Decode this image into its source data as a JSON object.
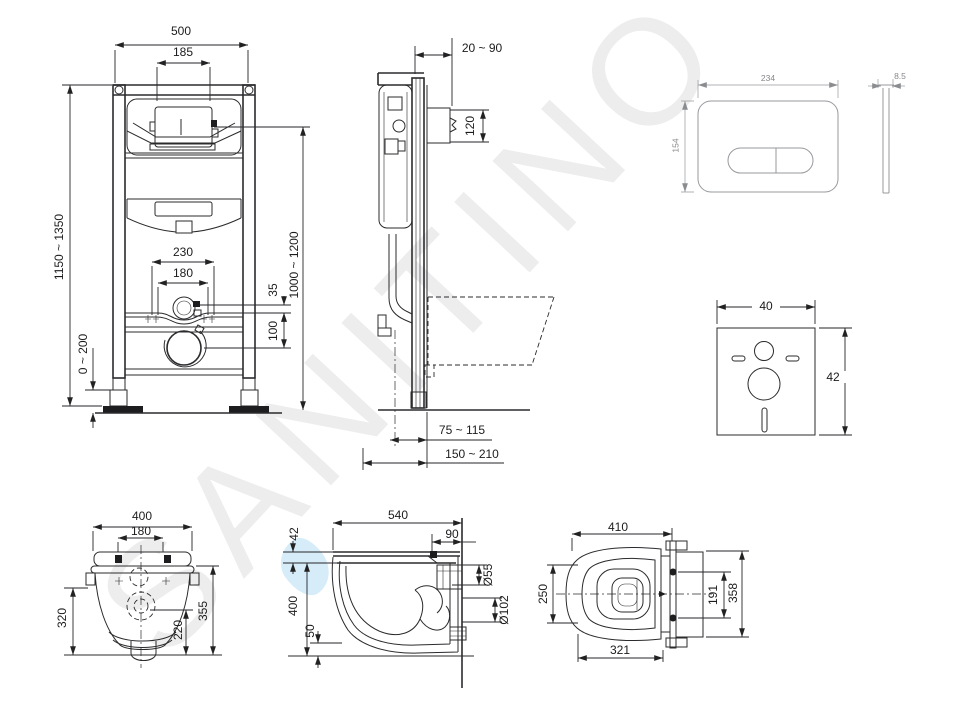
{
  "watermark": {
    "text": "SANITINO",
    "color": "#ededed",
    "drop_color": "#d6ecf8"
  },
  "views": {
    "frame_front": {
      "dims": {
        "overall_width": "500",
        "cistern_width": "185",
        "frame_height": "1150 ~ 1350",
        "leg_adjust": "0 ~ 200",
        "fixing_outer": "230",
        "fixing_inner": "180",
        "offset_small": "35",
        "offset_mid": "100",
        "outlet_height": "1000 ~ 1200"
      }
    },
    "frame_side": {
      "dims": {
        "wall_distance": "20 ~ 90",
        "spigot_length": "120",
        "outlet_offset": "75 ~ 115",
        "outlet_depth": "150 ~ 210"
      }
    },
    "flush_plate": {
      "dims": {
        "width": "234",
        "height": "154",
        "thickness": "8.5"
      }
    },
    "sound_pad": {
      "dims": {
        "width": "40",
        "height": "42"
      }
    },
    "bowl_rear": {
      "dims": {
        "width": "400",
        "hole_spacing": "180",
        "height_left": "320",
        "drain_height": "220",
        "hole_height": "355"
      }
    },
    "bowl_side": {
      "dims": {
        "depth": "540",
        "rear_ledge": "90",
        "seat_height": "42",
        "body_height": "400",
        "bottom_clearance": "50",
        "inlet_diameter": "Ø55",
        "outlet_diameter": "Ø102"
      }
    },
    "bowl_top": {
      "dims": {
        "depth": "410",
        "seat_width": "250",
        "bolt_spacing": "191",
        "overall_width": "358",
        "bowl_depth": "321"
      }
    }
  }
}
